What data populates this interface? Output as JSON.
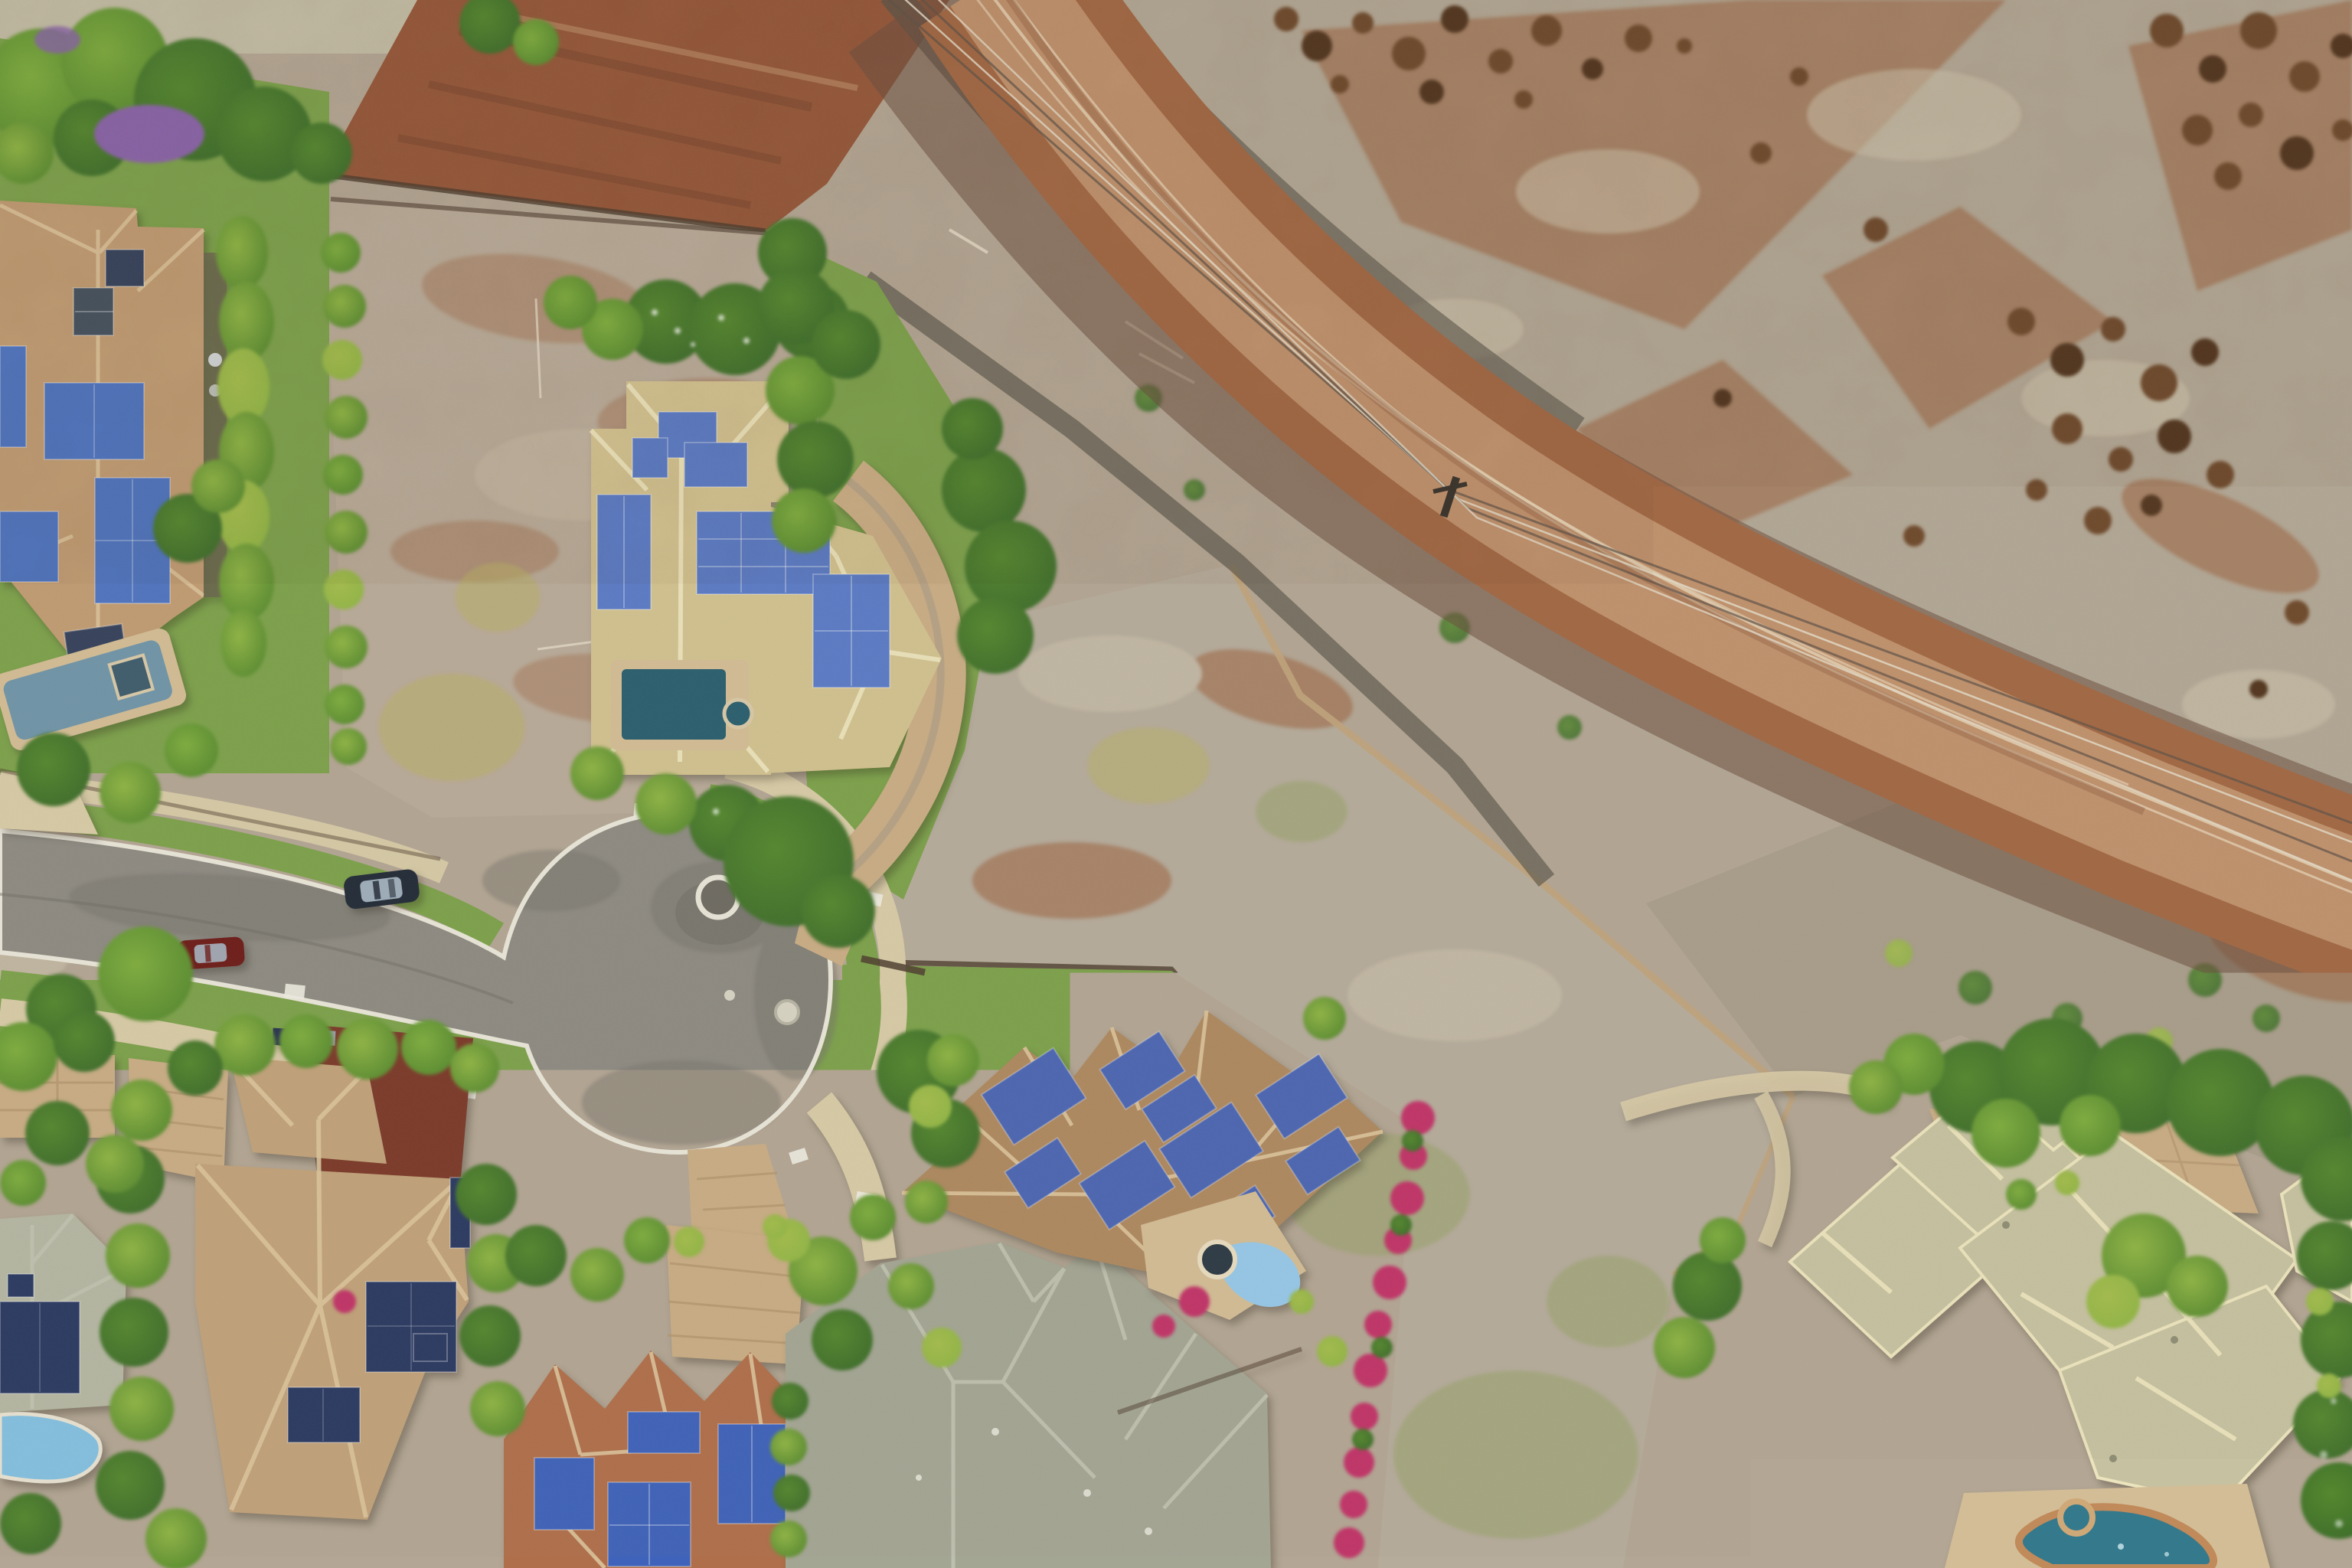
{
  "scene": {
    "type": "aerial-photograph",
    "title": "Aerial drone view of a residential neighborhood beside scrubland",
    "description": "Top-down drone photo of a luxury tropical neighborhood: homes with rooftop solar panels and swimming pools around an asphalt cul-de-sac, two graded vacant lots, a red dirt road with power lines crossing it, and dry rocky scrubland in the upper right. Two cars are parked on the street and lush hedges, palms and bougainvillea surround the houses.",
    "time_of_day": "daytime",
    "objects": {
      "houses": [
        {
          "id": "house-top-left",
          "roof": "tan shingle",
          "solar_panels": true,
          "pool": "grey-blue lap pool with spa"
        },
        {
          "id": "house-upper-middle",
          "roof": "pale khaki shingle",
          "solar_panels": true,
          "pool": "dark teal rectangle with round spa"
        },
        {
          "id": "house-bottom-left-large",
          "roof": "light brown shingle",
          "solar_panels": true,
          "pool": null,
          "extra": "maroon sport court"
        },
        {
          "id": "house-far-left-bottom",
          "roof": "sage tile",
          "solar_panels": true,
          "pool": "light blue lagoon"
        },
        {
          "id": "house-bottom-terracotta",
          "roof": "terracotta shingle",
          "solar_panels": true,
          "pool": null
        },
        {
          "id": "house-bottom-gray",
          "roof": "gray-green shingle",
          "solar_panels": false,
          "pool": null
        },
        {
          "id": "house-center-bottom",
          "roof": "brown shingle gabled",
          "solar_panels": true,
          "pool": "light blue plunge pool with dark spa"
        },
        {
          "id": "house-bottom-right-large",
          "roof": "pale sage-khaki shingle",
          "solar_panels": false,
          "pool": "teal kidney pool with spa"
        }
      ],
      "cars": [
        {
          "id": "car-suv",
          "color": "dark navy",
          "location": "parked on street near upper curb"
        },
        {
          "id": "car-sedan",
          "color": "dark red",
          "location": "parked along lower curb"
        }
      ],
      "street": {
        "surface": "gray asphalt",
        "feature": "cul-de-sac bulb",
        "curb_color": "white",
        "manholes": 2,
        "sidewalks": "tan concrete",
        "grass_strips": true
      },
      "dirt_road": {
        "surface": "red-brown dirt with light tire tracks",
        "power_lines": 4,
        "utility_poles": 1
      },
      "vacant_lots": 2,
      "scrubland": {
        "ground": "pale gray-tan brush",
        "boulders": "dark brown",
        "streaks": "red dirt"
      },
      "vegetation": [
        "palm trees",
        "clipped hedges",
        "magenta bougainvillea",
        "purple flowering tree",
        "green lawns",
        "yellow-green shrubs"
      ]
    },
    "palette": {
      "base": "#b3a694",
      "pale": "#c3bda6",
      "scrub": "#b2a795",
      "scrub2": "#a99e8b",
      "rock": "#6f4a2c",
      "rockDark": "#53361f",
      "tuft": "#cdc3ac",
      "dirtB": "#96583a",
      "dirtR": "#9a5c36",
      "roadD": "#a26844",
      "roadL": "#c59a74",
      "track": "#e9d9bd",
      "shoulder": "#6e5140",
      "burnt": "#59544a",
      "lot1": "#b9ab99",
      "lot2": "#b6ac9c",
      "wallT": "#c0a47c",
      "wallD": "#4f3e30",
      "weed": "#95a266",
      "dry": "#b8b066",
      "lawn": "#7da24c",
      "grassB": "#8fae55",
      "asphalt": "#8e8b83",
      "asphaltD": "#77746d",
      "curb": "#e9e6d9",
      "sidewalk": "#d8cba7",
      "paver": "#c9ad85",
      "paverL": "#b2946e",
      "deck": "#d3bd96",
      "maroon": "#7c3a2a",
      "roofA": "#c09c73",
      "roofB": "#d2c290",
      "roofC": "#c1a27a",
      "roofCL": "#b5b7a3",
      "roofD": "#ae8960",
      "roofE": "#c6c2a1",
      "roofF": "#a4a694",
      "roofG": "#b06f4b",
      "ridgeWarm": "#dcc49c",
      "ridgePale": "#ece4bd",
      "ridgeGray": "#c1c3b1",
      "panelA": "#4f74c0",
      "panelB": "#5b7bc6",
      "panelNavy": "#2b3a62",
      "panelD": "#4c66b2",
      "panelG": "#3f63ba",
      "panelGray": "#46525f",
      "panelDark": "#36425c",
      "poolA": "#7095a8",
      "spaA": "#3f5d6d",
      "poolB": "#2a5f6f",
      "poolD": "#96c8e8",
      "spaDark": "#2d3a45",
      "poolCL": "#84c0e0",
      "poolE": "#35798d",
      "coping": "#c08a5a",
      "treeDark": "#3c6b2b",
      "treeMid": "#55882f",
      "treeLight": "#7fae3f",
      "treeYellow": "#a4bd4d",
      "palm": "#8fb545",
      "bougain": "#c13468",
      "purple": "#8a64aa",
      "carNavy": "#232c38",
      "carRed": "#6e1d1a",
      "glass": "#a9bac6",
      "power": "#5f5348",
      "powerL": "#e3dbc8",
      "white": "#efece2"
    }
  }
}
